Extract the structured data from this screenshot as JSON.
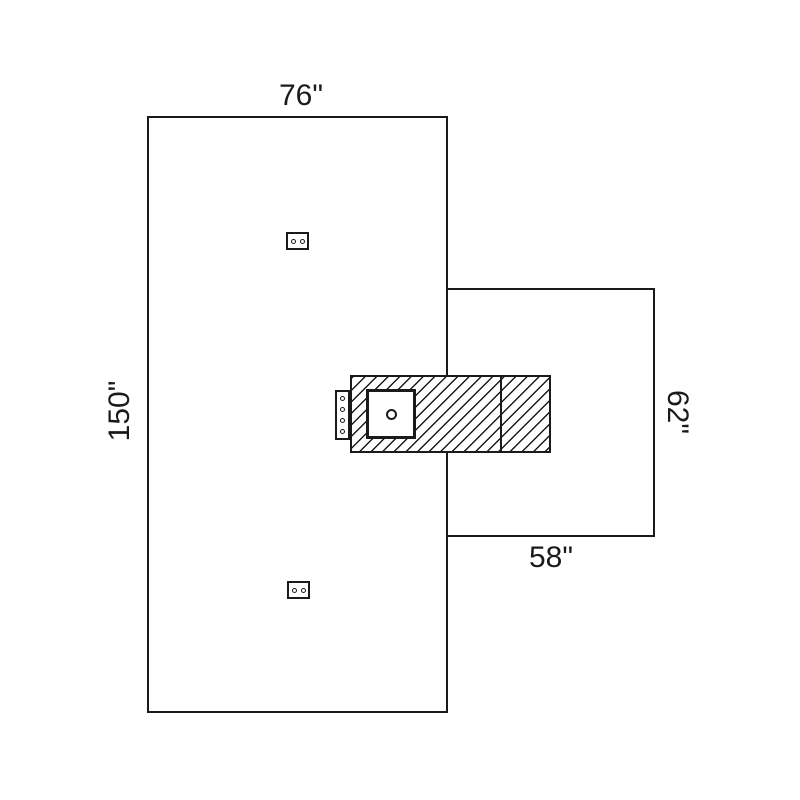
{
  "diagram": {
    "labels": {
      "main_width": "76\"",
      "main_length": "150\"",
      "extension_height": "62\"",
      "extension_width": "58\""
    },
    "colors": {
      "line": "#1a1a1a",
      "background": "#ffffff"
    }
  }
}
